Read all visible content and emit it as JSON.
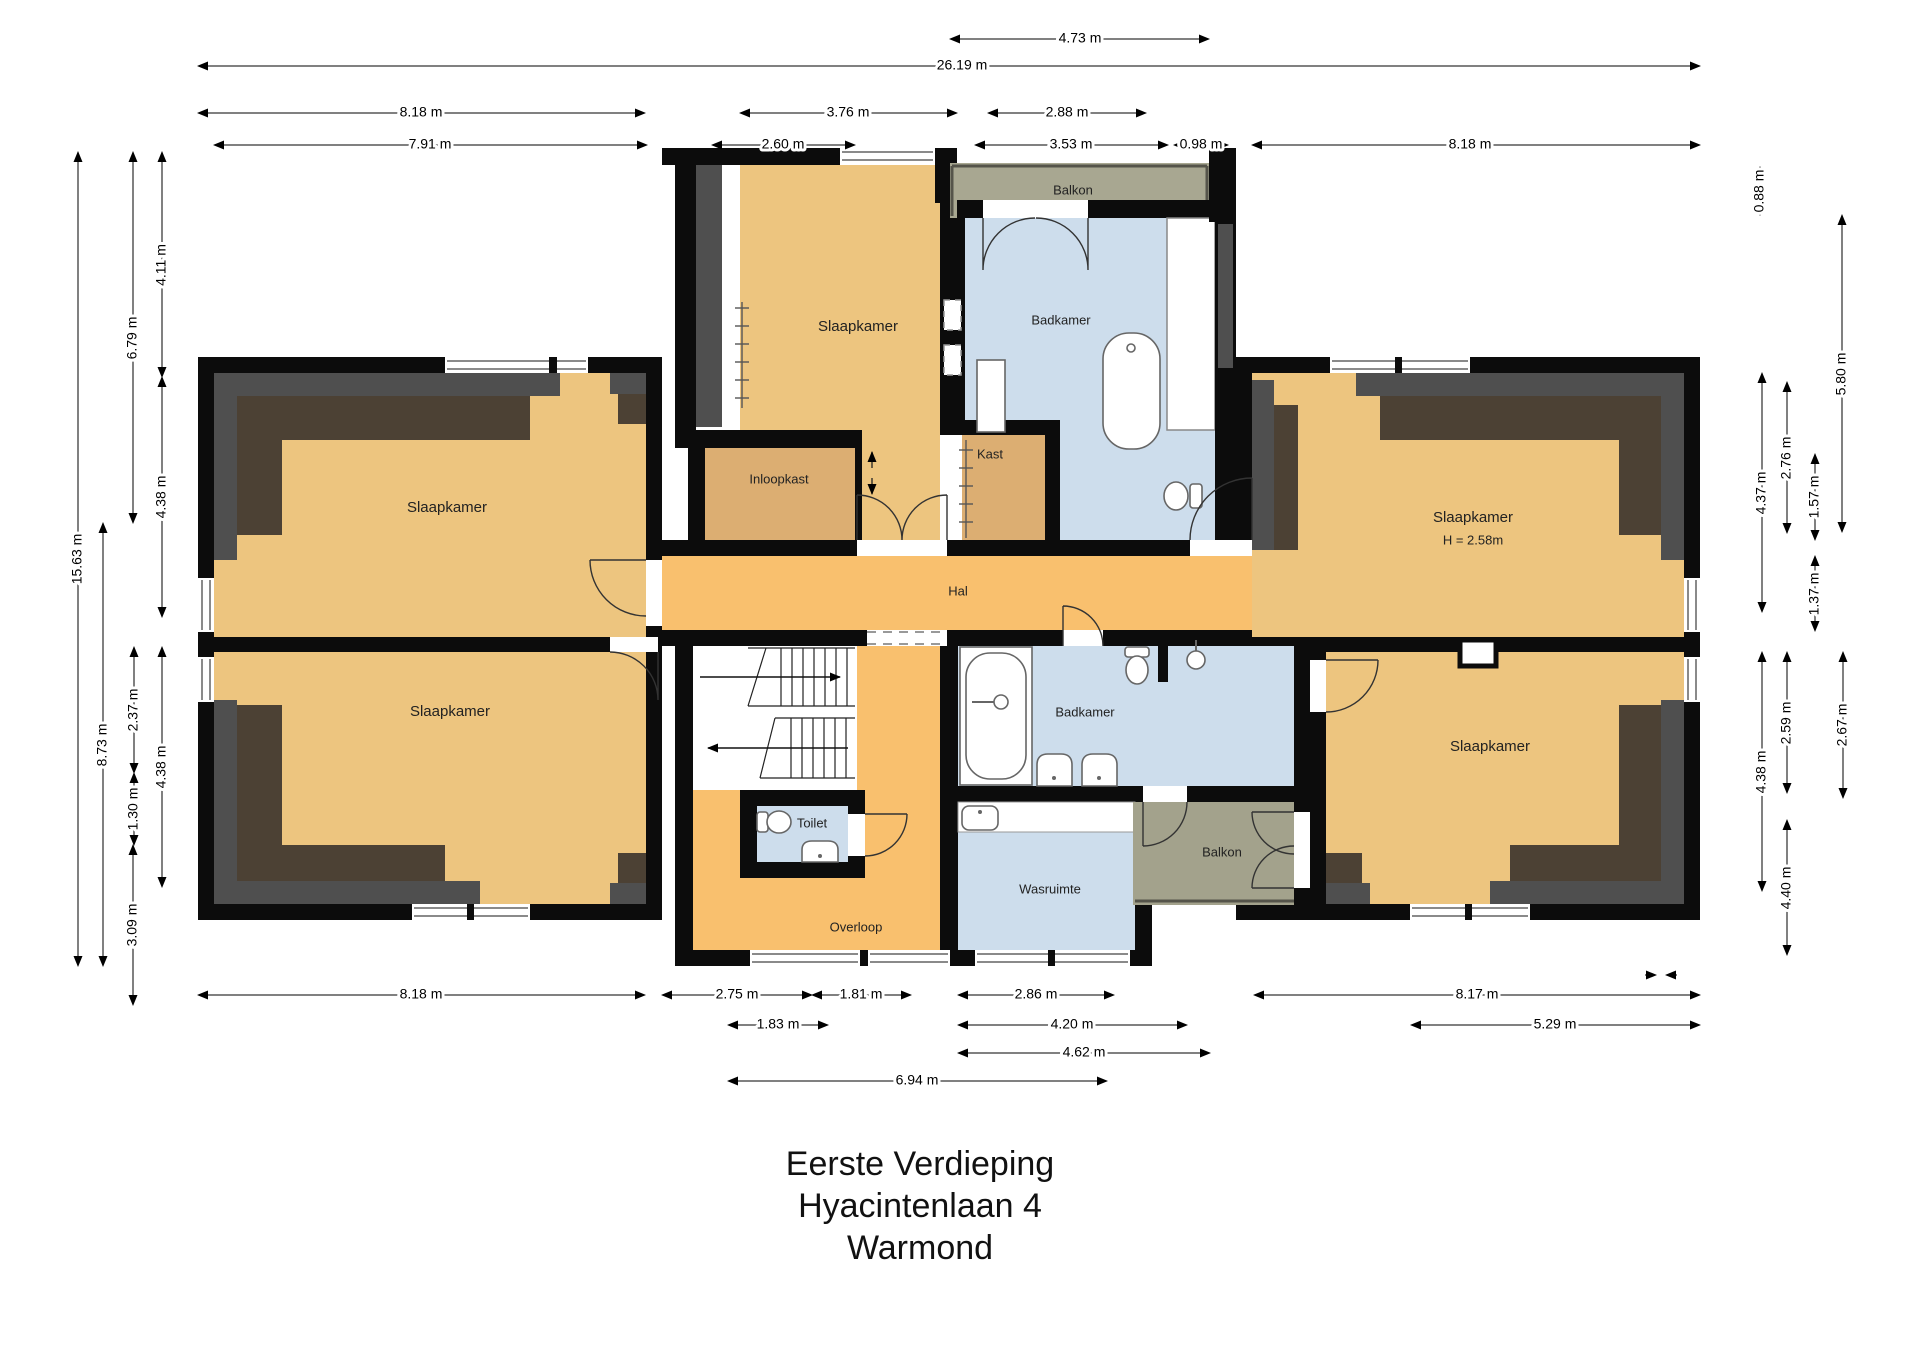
{
  "title": {
    "level": "Eerste Verdieping",
    "street": "Hyacintenlaan 4",
    "city": "Warmond"
  },
  "rooms": {
    "slaapkamer_left_top": "Slaapkamer",
    "slaapkamer_left_bottom": "Slaapkamer",
    "sla apkamer_note": "",
    "slaapkamer_mid_top": "Slaapkamer",
    "slaapkamer_right_top": "Slaapkamer",
    "slaapkamer_right_top_height": "H = 2.58m",
    "slaapkamer_right_bottom": "Slaapkamer",
    "badkamer_top": "Badkamer",
    "badkamer_bottom": "Badkamer",
    "balkon_top": "Balkon",
    "balkon_bottom": "Balkon",
    "inloopkast": "Inloopkast",
    "kast": "Kast",
    "hal": "Hal",
    "toilet": "Toilet",
    "overloop": "Overloop",
    "wasruimte": "Wasruimte"
  },
  "dims": {
    "top": {
      "d1": "4.73 m",
      "d2": "26.19 m",
      "d3a": "8.18 m",
      "d3b": "3.76 m",
      "d3c": "2.88 m",
      "d4a": "7.91 m",
      "d4b": "2.60 m",
      "d4c": "3.53 m",
      "d4d": "0.98 m",
      "d4e": "8.18 m"
    },
    "left": {
      "d1": "15.63 m",
      "d2": "6.79 m",
      "d3": "8.73 m",
      "d4": "4.11 m",
      "d5": "4.38 m",
      "d6": "2.37 m",
      "d7": "1.30 m",
      "d8": "3.09 m",
      "d9": "4.38 m"
    },
    "right": {
      "d1": "0.88 m",
      "d2": "5.80 m",
      "d3": "2.76 m",
      "d4": "1.57 m",
      "d5": "4.37 m",
      "d6": "1.37 m",
      "d7": "2.59 m",
      "d8": "4.38 m",
      "d9": "2.67 m",
      "d10": "4.40 m"
    },
    "bottom": {
      "d1a": "8.18 m",
      "d1b": "2.75 m",
      "d1c": "1.81 m",
      "d1d": "2.86 m",
      "d1e": "8.17 m",
      "d2a": "1.83 m",
      "d2b": "4.20 m",
      "d2c": "5.29 m",
      "d3": "4.62 m",
      "d4": "6.94 m"
    }
  },
  "colors": {
    "wall": "#0c0c0c",
    "bedroom": "#edc57f",
    "closet": "#dcae72",
    "hall": "#f9c06e",
    "bathroom": "#cdddec",
    "balcony": "#a8a791",
    "roof_slope_gray": "#4f4f4f",
    "roof_slope_brown": "#4c4134"
  }
}
